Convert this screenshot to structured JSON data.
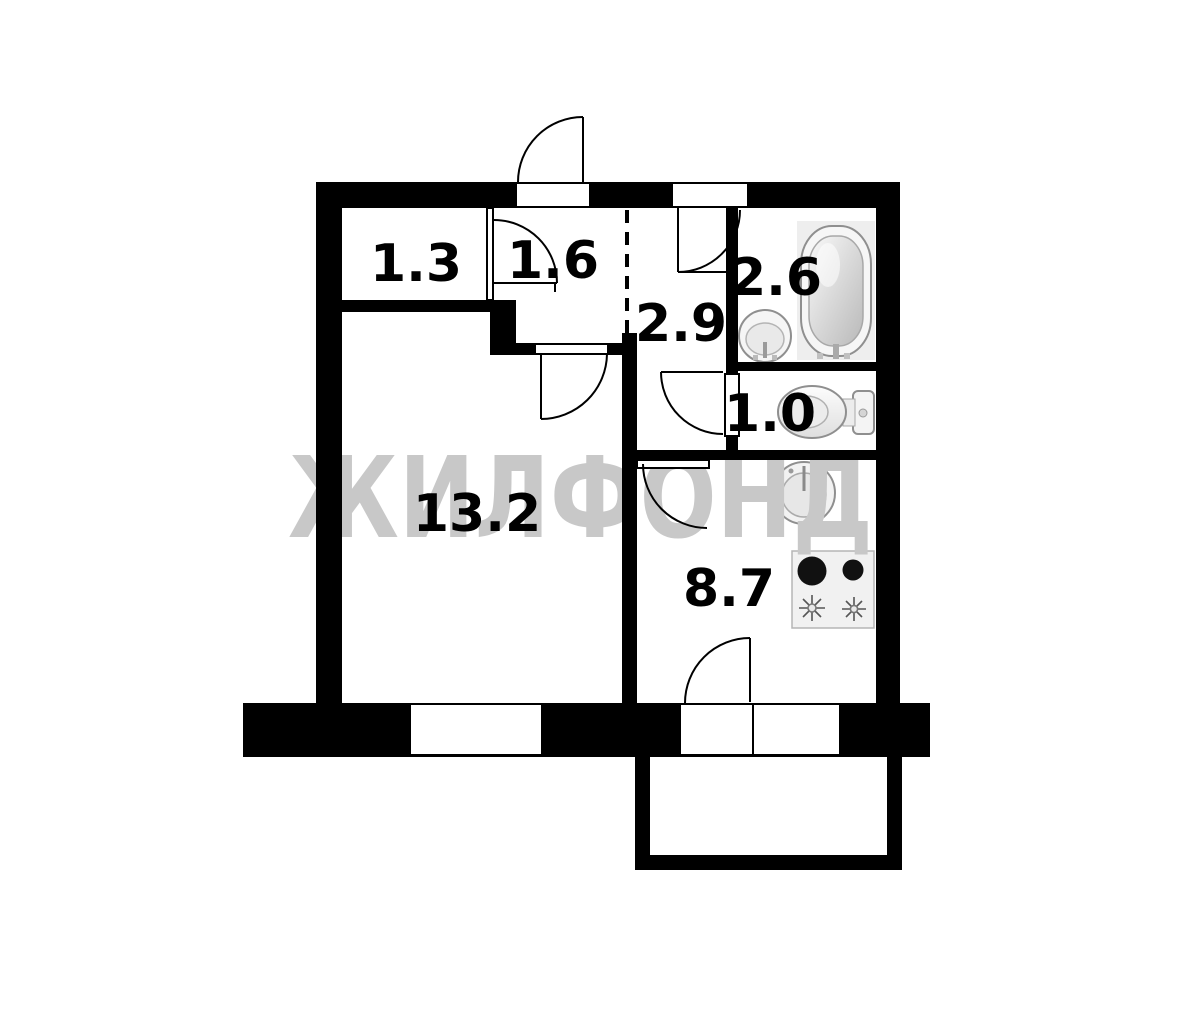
{
  "plan": {
    "type": "apartment-floor-plan",
    "watermark": {
      "text": "ЖИЛФОНД",
      "color": "#c8c8c8"
    },
    "rooms": [
      {
        "name": "closet-left",
        "area": "1.3"
      },
      {
        "name": "closet-right",
        "area": "1.6"
      },
      {
        "name": "hallway",
        "area": "2.9"
      },
      {
        "name": "bathroom",
        "area": "2.6"
      },
      {
        "name": "toilet",
        "area": "1.0"
      },
      {
        "name": "living-room",
        "area": "13.2"
      },
      {
        "name": "kitchen",
        "area": "8.7"
      }
    ],
    "fixtures": [
      "bathtub",
      "washbasin",
      "toilet-bowl",
      "kitchen-sink",
      "stove",
      "balcony"
    ],
    "colors": {
      "wall": "#000000",
      "background": "#ffffff",
      "fixture_fill": "#f2f2f2",
      "fixture_stroke": "#8f8f8f",
      "label": "#000000"
    }
  }
}
